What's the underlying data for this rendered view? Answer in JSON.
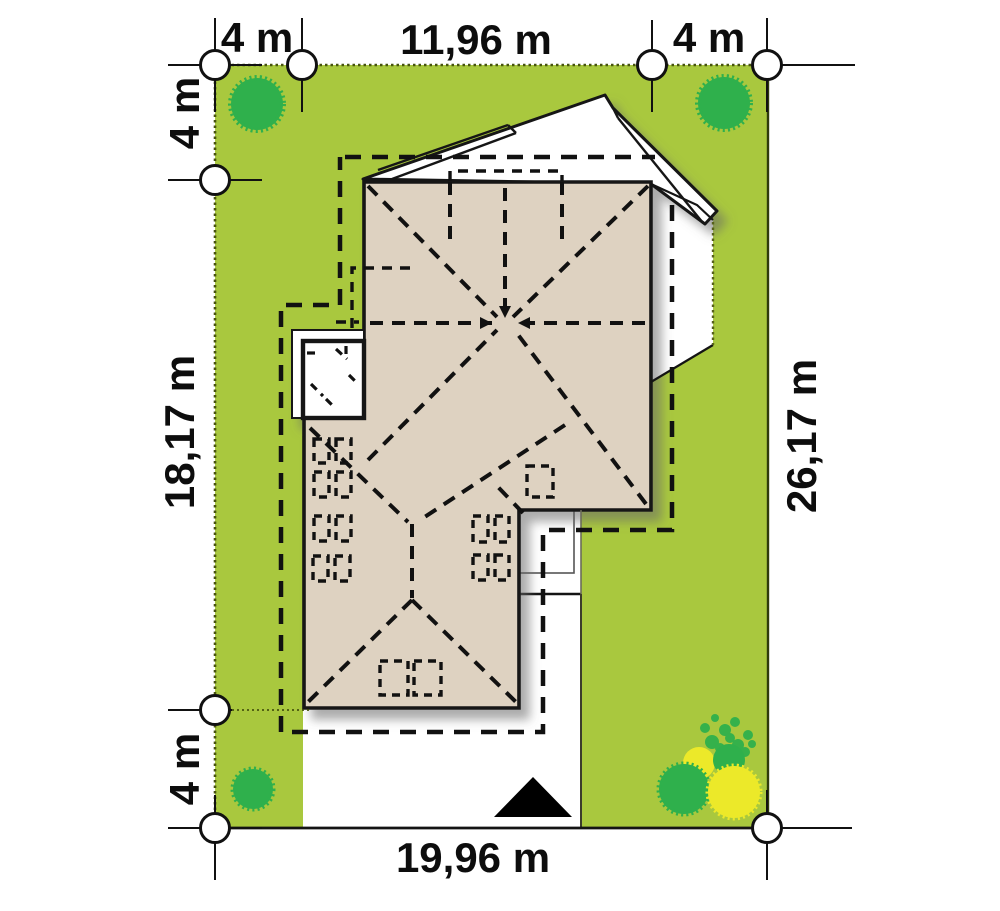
{
  "title": "House site plan with plot setbacks",
  "dimensions": {
    "top_left_setback": "4 m",
    "building_width": "11,96 m",
    "top_right_setback": "4 m",
    "left_upper_setback": "4 m",
    "building_depth": "18,17 m",
    "left_lower_setback": "4 m",
    "plot_width": "19,96 m",
    "plot_depth": "26,17 m"
  },
  "colors": {
    "lawn": "#a9c83e",
    "roof": "#ded2c1",
    "roof_outline": "#141414",
    "tree_green": "#2fb04c",
    "bush_yellow": "#ece929",
    "dashed_line": "#111111",
    "paving_white": "#ffffff"
  },
  "elements": {
    "trees": 3,
    "bush_cluster": "green and yellow bushes, bottom-right corner",
    "north_marker": "black triangle on driveway",
    "setback_outline": "dashed line around building",
    "skylights": "dashed roof window rectangles"
  }
}
